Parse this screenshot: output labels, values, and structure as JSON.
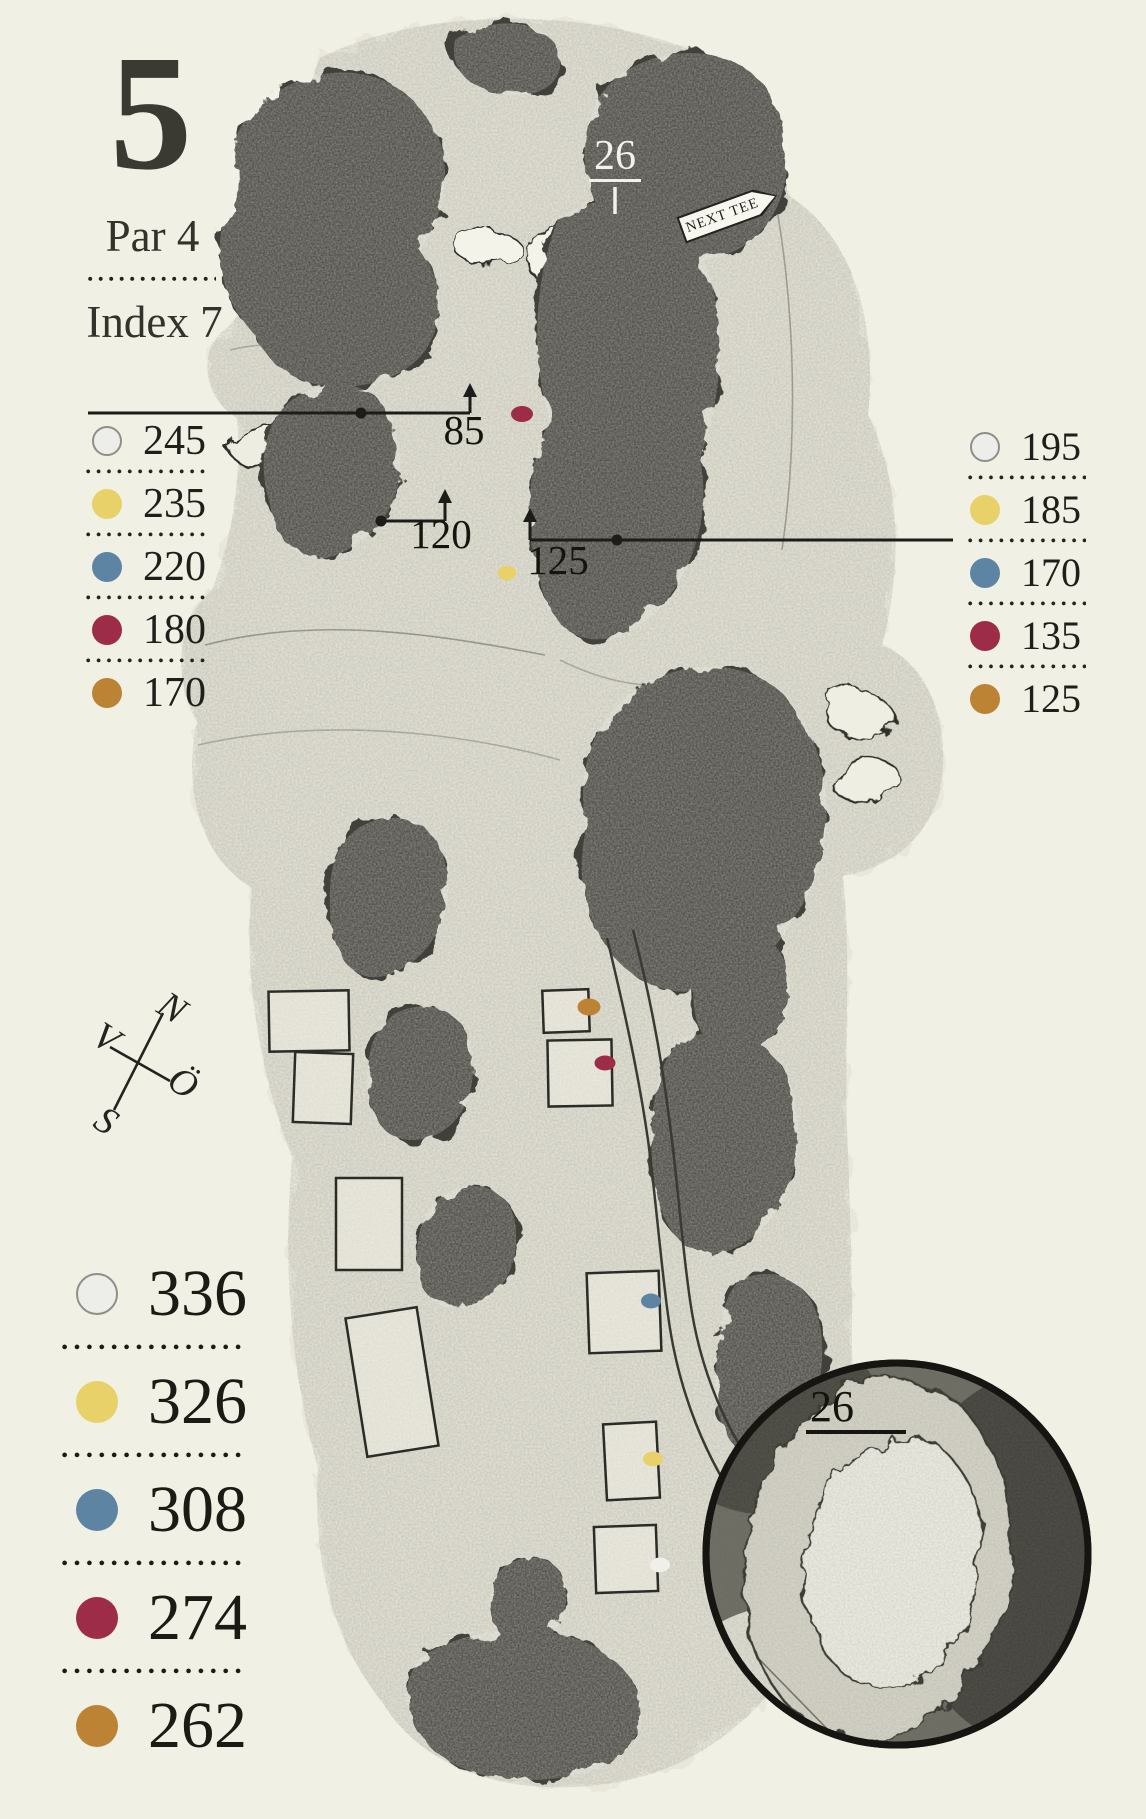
{
  "hole": {
    "number": "5",
    "par": "Par 4",
    "index": "Index 7"
  },
  "map": {
    "green_depth": "26",
    "inset_green_depth": "26",
    "next_tee_sign": "NEXT TEE",
    "carry_labels": {
      "left": "85",
      "mid": "120",
      "right": "125"
    }
  },
  "compass": {
    "north": "N",
    "east": "Ö",
    "south": "S",
    "west": "V"
  },
  "colors": {
    "paper": "#f1f0e5",
    "ink": "#23231f",
    "tee_white": "#ededea",
    "tee_yellow": "#e8d169",
    "tee_blue": "#5d85a3",
    "tee_red": "#9d2c48",
    "tee_brown": "#bd8334"
  },
  "left_carry_distances": {
    "items": [
      {
        "tee": "white",
        "value": "245"
      },
      {
        "tee": "yellow",
        "value": "235"
      },
      {
        "tee": "blue",
        "value": "220"
      },
      {
        "tee": "red",
        "value": "180"
      },
      {
        "tee": "brown",
        "value": "170"
      }
    ]
  },
  "right_carry_distances": {
    "items": [
      {
        "tee": "white",
        "value": "195"
      },
      {
        "tee": "yellow",
        "value": "185"
      },
      {
        "tee": "blue",
        "value": "170"
      },
      {
        "tee": "red",
        "value": "135"
      },
      {
        "tee": "brown",
        "value": "125"
      }
    ]
  },
  "total_distances": {
    "items": [
      {
        "tee": "white",
        "value": "336"
      },
      {
        "tee": "yellow",
        "value": "326"
      },
      {
        "tee": "blue",
        "value": "308"
      },
      {
        "tee": "red",
        "value": "274"
      },
      {
        "tee": "brown",
        "value": "262"
      }
    ]
  }
}
